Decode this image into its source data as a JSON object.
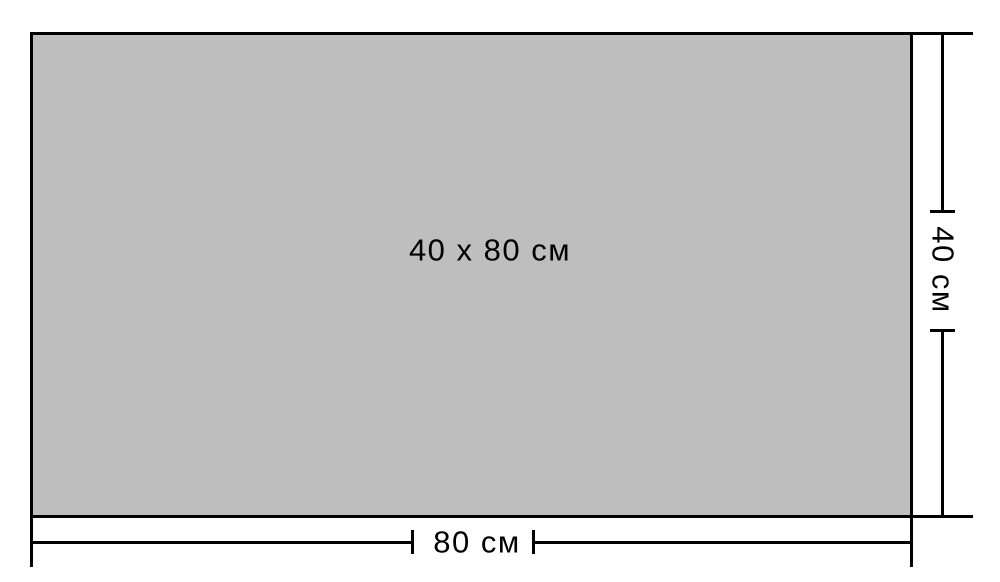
{
  "diagram": {
    "size_label": "40 x 80 см",
    "width_label": "80 см",
    "height_label": "40 см"
  },
  "colors": {
    "background": "#ffffff",
    "rect_fill": "#bebebe",
    "line": "#000000",
    "text": "#000000"
  }
}
